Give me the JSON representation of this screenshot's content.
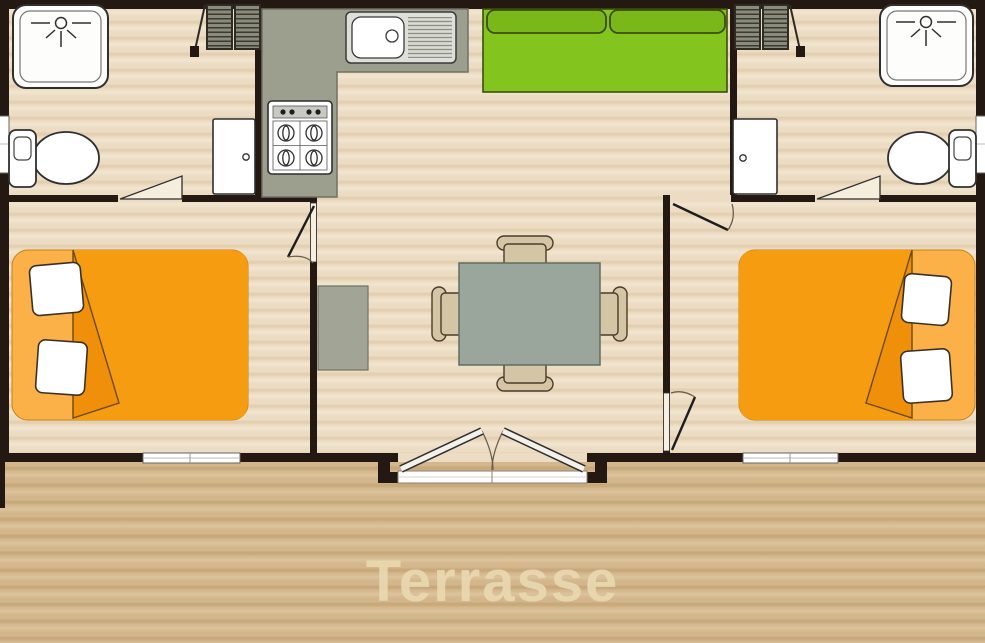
{
  "plan": {
    "terrace_label": "Terrasse",
    "rooms": [
      {
        "name": "bathroom-left",
        "fixtures": [
          "shower",
          "toilet",
          "door",
          "louvered-window"
        ]
      },
      {
        "name": "kitchen",
        "fixtures": [
          "l-shaped-counter",
          "sink-with-drainer",
          "gas-hob-4-burners"
        ]
      },
      {
        "name": "living-dining",
        "fixtures": [
          "green-sofa",
          "dining-table",
          "four-chairs",
          "side-table",
          "double-entrance-doors"
        ]
      },
      {
        "name": "bathroom-right",
        "fixtures": [
          "shower",
          "toilet",
          "door",
          "louvered-window"
        ]
      },
      {
        "name": "bedroom-left",
        "fixtures": [
          "double-bed",
          "two-pillows",
          "window"
        ]
      },
      {
        "name": "bedroom-right",
        "fixtures": [
          "double-bed",
          "two-pillows",
          "window"
        ]
      },
      {
        "name": "terrace",
        "fixtures": []
      }
    ],
    "colors": {
      "wall": "#241912",
      "floor": "#ecdcc3",
      "floor_s1": "#e3d0b2",
      "floor_s2": "#f2e5cf",
      "terrace": "#d3b68c",
      "terr_s1": "#c8a97b",
      "terr_s2": "#dcc49c",
      "counter": "#9c9e8e",
      "counter_border": "#6e7162",
      "sofa": "#84c41e",
      "sofa_dark": "#79b818",
      "sofa_border": "#3c4d0c",
      "bed": "#f59c10",
      "bed_light": "#fbb148",
      "bed_fold": "#f0900a",
      "bed_outline": "#6b4a08",
      "table": "#9aa59b",
      "table_border": "#5e6e60",
      "chair": "#d4c5a4",
      "chair_border": "#4a3c2a",
      "gray_furn": "#a2a496",
      "outline": "#2f2f2f",
      "louver": "#8b8b7d",
      "louver_line": "#3a3a30",
      "label": "#ead9b2"
    }
  }
}
